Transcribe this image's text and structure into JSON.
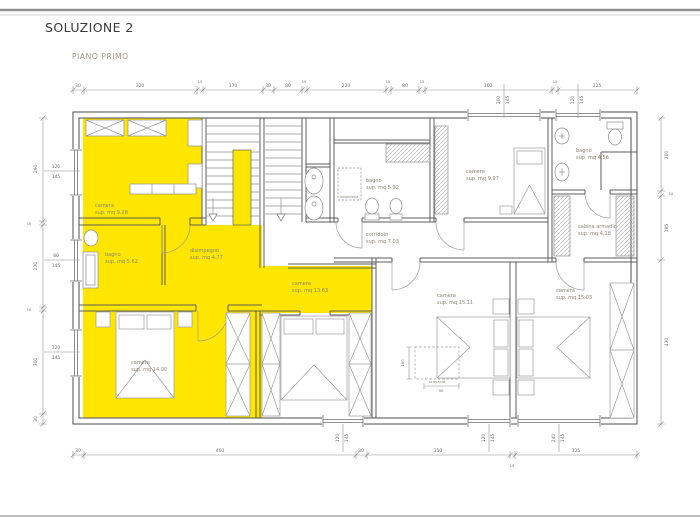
{
  "page": {
    "title": "SOLUZIONE 2",
    "subtitle": "PIANO PRIMO"
  },
  "colors": {
    "highlight_yellow": "#ffe600",
    "wall_line": "#5c5c5c",
    "furniture_line": "#9b9b9b",
    "dimension_line": "#8f8f8f",
    "room_label_text": "#8a8577"
  },
  "rooms": {
    "camera1": {
      "name": "camera",
      "area": "sup. mq 9.28"
    },
    "bagno1": {
      "name": "bagno",
      "area": "sup. mq 5.62"
    },
    "disimpegno": {
      "name": "disimpegno",
      "area": "sup. mq 4.77"
    },
    "camera2": {
      "name": "camera",
      "area": "sup. mq 14.00"
    },
    "camera3": {
      "name": "camera",
      "area": "sup. mq 13.63"
    },
    "bagno2": {
      "name": "bagno",
      "area": "sup. mq 5.92"
    },
    "lavanderia": {
      "name": "lavanderia"
    },
    "corridoio": {
      "name": "corridoio",
      "area": "sup. mq 7.03"
    },
    "camera4": {
      "name": "camera",
      "area": "sup. mq 9.97"
    },
    "bagno3": {
      "name": "bagno",
      "area": "sup. mq 4.56"
    },
    "cabina": {
      "name": "cabina armadio",
      "area": "sup. mq 4.18"
    },
    "camera5": {
      "name": "camera",
      "area": "sup. mq 15.11"
    },
    "camera6": {
      "name": "camera",
      "area": "sup. mq 15.03"
    },
    "scrivania": {
      "name": "scrivania"
    }
  },
  "dims": {
    "top": [
      "30",
      "320",
      "15",
      "170",
      "30",
      "80",
      "15",
      "220",
      "15",
      "80",
      "15",
      "360",
      "15",
      "225"
    ],
    "bottom": [
      "30",
      "460",
      "30",
      "350",
      "325"
    ],
    "bottom_gap": "15",
    "left": [
      "290",
      "10",
      "230",
      "10",
      "300",
      "30"
    ],
    "right": [
      "200",
      "10",
      "185",
      "430"
    ],
    "desk_h": "100",
    "desk_w": "90"
  },
  "windows": {
    "top": [
      {
        "w": "200",
        "h": "145"
      },
      {
        "w": "120",
        "h": "145"
      }
    ],
    "left": [
      {
        "w": "120",
        "h": "145"
      },
      {
        "w": "80",
        "h": "145"
      },
      {
        "w": "120",
        "h": "145"
      }
    ],
    "bottom": [
      {
        "w": "120",
        "h": "145"
      },
      {
        "w": "120",
        "h": "145"
      },
      {
        "w": "240",
        "h": "145"
      }
    ]
  }
}
